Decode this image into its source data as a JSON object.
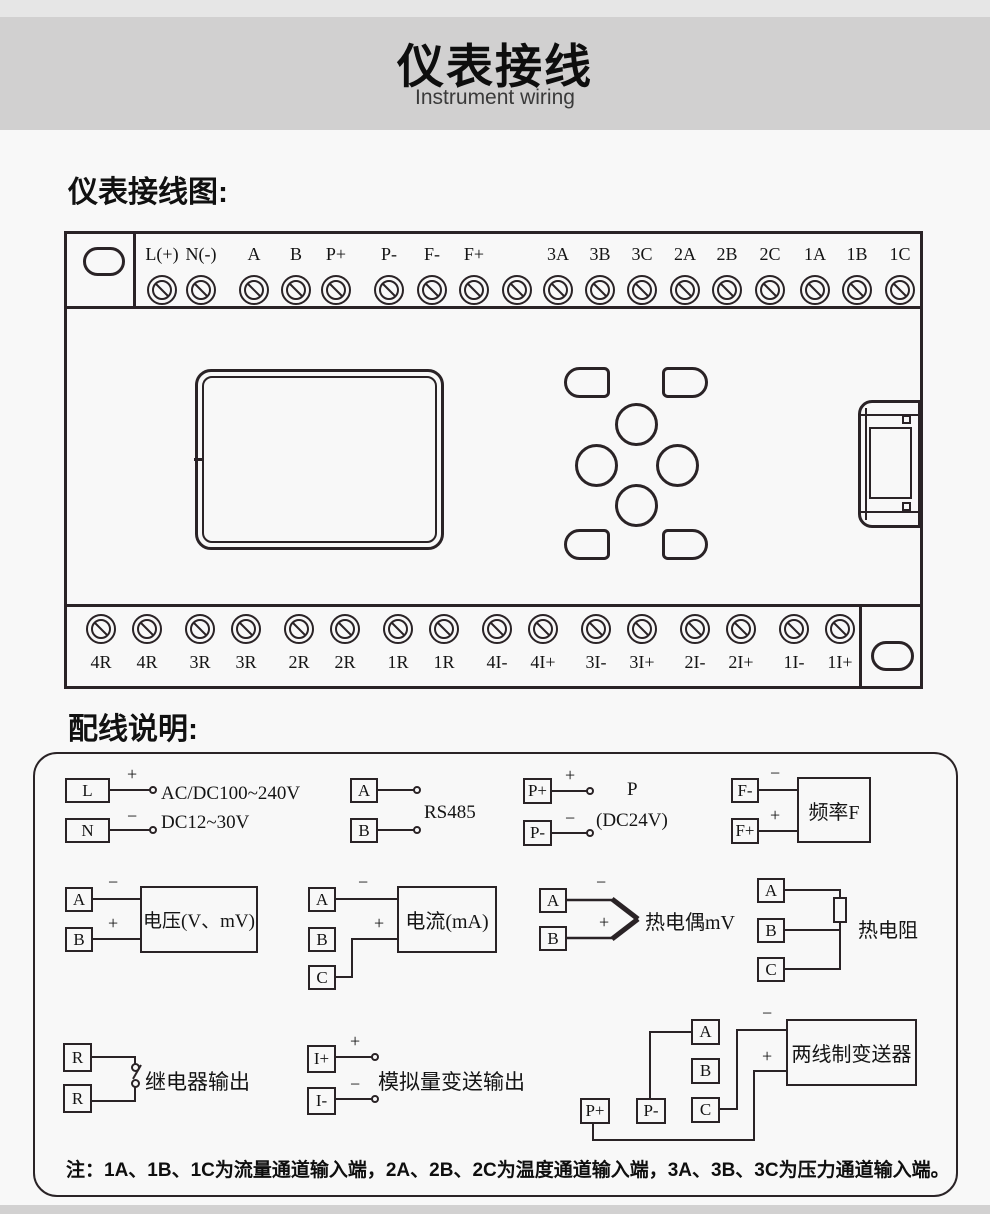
{
  "page": {
    "title": "仪表接线",
    "subtitle": "Instrument wiring",
    "section1_heading": "仪表接线图:",
    "section2_heading": "配线说明:"
  },
  "signs": {
    "plus": "+",
    "minus": "−"
  },
  "diagram": {
    "top_terminals": [
      "L(+)",
      "N(-)",
      "A",
      "B",
      "P+",
      "P-",
      "F-",
      "F+",
      "3A",
      "3B",
      "3C",
      "2A",
      "2B",
      "2C",
      "1A",
      "1B",
      "1C"
    ],
    "bottom_terminals": [
      "4R",
      "4R",
      "3R",
      "3R",
      "2R",
      "2R",
      "1R",
      "1R",
      "4I-",
      "4I+",
      "3I-",
      "3I+",
      "2I-",
      "2I+",
      "1I-",
      "1I+"
    ]
  },
  "wiring": {
    "power": {
      "t1": "L",
      "t2": "N",
      "line1": "AC/DC100~240V",
      "line2": "DC12~30V"
    },
    "rs485": {
      "t1": "A",
      "t2": "B",
      "label": "RS485"
    },
    "p24": {
      "t1": "P+",
      "t2": "P-",
      "line1": "P",
      "line2": "(DC24V)"
    },
    "freq": {
      "t1": "F-",
      "t2": "F+",
      "label": "频率F"
    },
    "voltage": {
      "t1": "A",
      "t2": "B",
      "label": "电压(V、mV)"
    },
    "current": {
      "t1": "A",
      "t2": "B",
      "t3": "C",
      "label": "电流(mA)"
    },
    "thermocouple": {
      "t1": "A",
      "t2": "B",
      "label": "热电偶mV"
    },
    "rtd": {
      "t1": "A",
      "t2": "B",
      "t3": "C",
      "label": "热电阻"
    },
    "relay": {
      "t1": "R",
      "t2": "R",
      "label": "继电器输出"
    },
    "analog_out": {
      "t1": "I+",
      "t2": "I-",
      "label": "模拟量变送输出"
    },
    "transmitter": {
      "t1": "A",
      "t2": "B",
      "t3": "C",
      "t4": "P+",
      "t5": "P-",
      "label": "两线制变送器"
    },
    "note": "注：1A、1B、1C为流量通道输入端，2A、2B、2C为温度通道输入端，3A、3B、3C为压力通道输入端。"
  },
  "colors": {
    "band": "#d1d0d0",
    "page_bg": "#f8f8f8",
    "ink": "#2a2326"
  }
}
